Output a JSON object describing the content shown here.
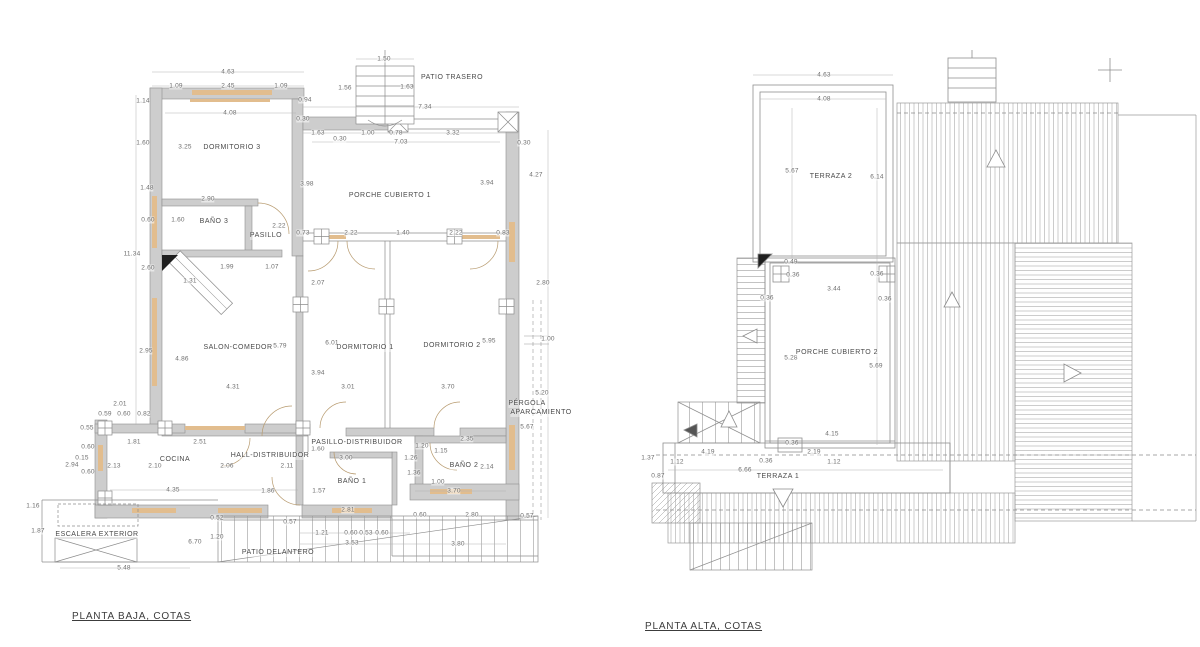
{
  "titles": {
    "left": "PLANTA BAJA, COTAS",
    "right": "PLANTA ALTA, COTAS"
  },
  "colors": {
    "wall_fill": "#cdcdcd",
    "wall_edge": "#8f8f8f",
    "line": "#8c8c8c",
    "window_wood": "#e2bd8e",
    "dim_text": "#6e6e6e",
    "room_text": "#4a4a4a",
    "black_marker": "#1f1f1f"
  },
  "left_plan": {
    "rooms": [
      [
        "DORMITORIO 3",
        232,
        148
      ],
      [
        "BAÑO 3",
        214,
        222
      ],
      [
        "PASILLO",
        266,
        236
      ],
      [
        "PORCHE CUBIERTO 1",
        390,
        196
      ],
      [
        "SALON-COMEDOR",
        238,
        348
      ],
      [
        "DORMITORIO 1",
        365,
        348
      ],
      [
        "DORMITORIO 2",
        452,
        346
      ],
      [
        "COCINA",
        175,
        460
      ],
      [
        "HALL-DISTRIBUIDOR",
        270,
        456
      ],
      [
        "PASILLO-DISTRIBUIDOR",
        357,
        443
      ],
      [
        "BAÑO 1",
        352,
        482
      ],
      [
        "BAÑO 2",
        464,
        466
      ],
      [
        "ESCALERA EXTERIOR",
        97,
        535
      ],
      [
        "PATIO DELANTERO",
        278,
        553
      ],
      [
        "PATIO TRASERO",
        452,
        78
      ],
      [
        "PÉRGOLA",
        527,
        404
      ],
      [
        "APARCAMIENTO",
        541,
        413
      ]
    ],
    "dims": [
      [
        "4.63",
        228,
        72
      ],
      [
        "1.09",
        176,
        86
      ],
      [
        "2.45",
        228,
        86
      ],
      [
        "1.09",
        281,
        86
      ],
      [
        "1.14",
        143,
        101
      ],
      [
        "4.08",
        230,
        113
      ],
      [
        "1.60",
        143,
        143
      ],
      [
        "3.25",
        185,
        147
      ],
      [
        "1.50",
        384,
        59
      ],
      [
        "1.56",
        345,
        88
      ],
      [
        "1.63",
        407,
        87
      ],
      [
        "7.34",
        425,
        107
      ],
      [
        "0.94",
        305,
        100
      ],
      [
        "0.30",
        303,
        119
      ],
      [
        "1.63",
        318,
        133
      ],
      [
        "0.30",
        340,
        139
      ],
      [
        "1.00",
        368,
        133
      ],
      [
        "0.78",
        396,
        133
      ],
      [
        "3.32",
        453,
        133
      ],
      [
        "7.03",
        401,
        142
      ],
      [
        "0.30",
        524,
        143
      ],
      [
        "1.48",
        147,
        188
      ],
      [
        "2.90",
        208,
        199
      ],
      [
        "0.60",
        148,
        220
      ],
      [
        "1.60",
        178,
        220
      ],
      [
        "2.22",
        279,
        226
      ],
      [
        "3.98",
        307,
        184
      ],
      [
        "3.94",
        487,
        183
      ],
      [
        "4.27",
        536,
        175
      ],
      [
        "11.34",
        132,
        254
      ],
      [
        "2.60",
        148,
        268
      ],
      [
        "1.31",
        190,
        281
      ],
      [
        "1.99",
        227,
        267
      ],
      [
        "1.07",
        272,
        267
      ],
      [
        "0.73",
        303,
        233
      ],
      [
        "2.22",
        351,
        233
      ],
      [
        "1.40",
        403,
        233
      ],
      [
        "2.22",
        456,
        233
      ],
      [
        "0.83",
        503,
        233
      ],
      [
        "2.07",
        318,
        283
      ],
      [
        "2.80",
        543,
        283
      ],
      [
        "2.95",
        146,
        351
      ],
      [
        "4.86",
        182,
        359
      ],
      [
        "5.79",
        280,
        346
      ],
      [
        "6.01",
        332,
        343
      ],
      [
        "3.94",
        318,
        373
      ],
      [
        "5.95",
        489,
        341
      ],
      [
        "1.00",
        548,
        339
      ],
      [
        "4.31",
        233,
        387
      ],
      [
        "3.01",
        348,
        387
      ],
      [
        "3.70",
        448,
        387
      ],
      [
        "5.20",
        542,
        393
      ],
      [
        "2.01",
        120,
        404
      ],
      [
        "0.82",
        144,
        414
      ],
      [
        "0.59",
        105,
        414
      ],
      [
        "0.60",
        124,
        414
      ],
      [
        "0.55",
        87,
        428
      ],
      [
        "1.81",
        134,
        442
      ],
      [
        "2.51",
        200,
        442
      ],
      [
        "0.60",
        88,
        447
      ],
      [
        "0.15",
        82,
        458
      ],
      [
        "2.94",
        72,
        465
      ],
      [
        "0.60",
        88,
        472
      ],
      [
        "2.13",
        114,
        466
      ],
      [
        "2.10",
        155,
        466
      ],
      [
        "2.06",
        227,
        466
      ],
      [
        "2.11",
        287,
        466
      ],
      [
        "1.60",
        318,
        449
      ],
      [
        "3.00",
        346,
        458
      ],
      [
        "1.26",
        411,
        458
      ],
      [
        "1.20",
        422,
        446
      ],
      [
        "1.15",
        441,
        451
      ],
      [
        "2.35",
        467,
        439
      ],
      [
        "2.14",
        487,
        467
      ],
      [
        "1.36",
        414,
        473
      ],
      [
        "1.00",
        438,
        482
      ],
      [
        "3.70",
        454,
        491
      ],
      [
        "1.57",
        319,
        491
      ],
      [
        "4.35",
        173,
        490
      ],
      [
        "1.86",
        268,
        491
      ],
      [
        "5.67",
        527,
        427
      ],
      [
        "2.81",
        348,
        510
      ],
      [
        "0.60",
        420,
        515
      ],
      [
        "2.80",
        472,
        515
      ],
      [
        "0.57",
        527,
        516
      ],
      [
        "0.52",
        217,
        518
      ],
      [
        "0.57",
        290,
        522
      ],
      [
        "1.21",
        322,
        533
      ],
      [
        "0.60",
        351,
        533
      ],
      [
        "0.53",
        366,
        533
      ],
      [
        "0.60",
        382,
        533
      ],
      [
        "3.53",
        352,
        543
      ],
      [
        "3.80",
        458,
        544
      ],
      [
        "1.16",
        33,
        506
      ],
      [
        "1.87",
        38,
        531
      ],
      [
        "5.48",
        124,
        568
      ],
      [
        "1.20",
        217,
        537
      ],
      [
        "6.70",
        195,
        542
      ]
    ]
  },
  "right_plan": {
    "rooms": [
      [
        "TERRAZA 2",
        831,
        177
      ],
      [
        "PORCHE CUBIERTO 2",
        837,
        353
      ],
      [
        "TERRAZA 1",
        778,
        477
      ]
    ],
    "dims": [
      [
        "4.63",
        824,
        75
      ],
      [
        "4.08",
        824,
        99
      ],
      [
        "5.67",
        792,
        171
      ],
      [
        "6.14",
        877,
        177
      ],
      [
        "0.49",
        791,
        262
      ],
      [
        "0.36",
        793,
        275
      ],
      [
        "0.36",
        877,
        274
      ],
      [
        "3.44",
        834,
        289
      ],
      [
        "0.36",
        767,
        298
      ],
      [
        "0.36",
        885,
        299
      ],
      [
        "5.28",
        791,
        358
      ],
      [
        "5.69",
        876,
        366
      ],
      [
        "4.15",
        832,
        434
      ],
      [
        "0.36",
        792,
        443
      ],
      [
        "4.19",
        708,
        452
      ],
      [
        "2.19",
        814,
        452
      ],
      [
        "0.36",
        766,
        461
      ],
      [
        "1.37",
        648,
        458
      ],
      [
        "1.12",
        677,
        462
      ],
      [
        "1.12",
        834,
        462
      ],
      [
        "6.66",
        745,
        470
      ],
      [
        "0.87",
        658,
        476
      ]
    ]
  }
}
